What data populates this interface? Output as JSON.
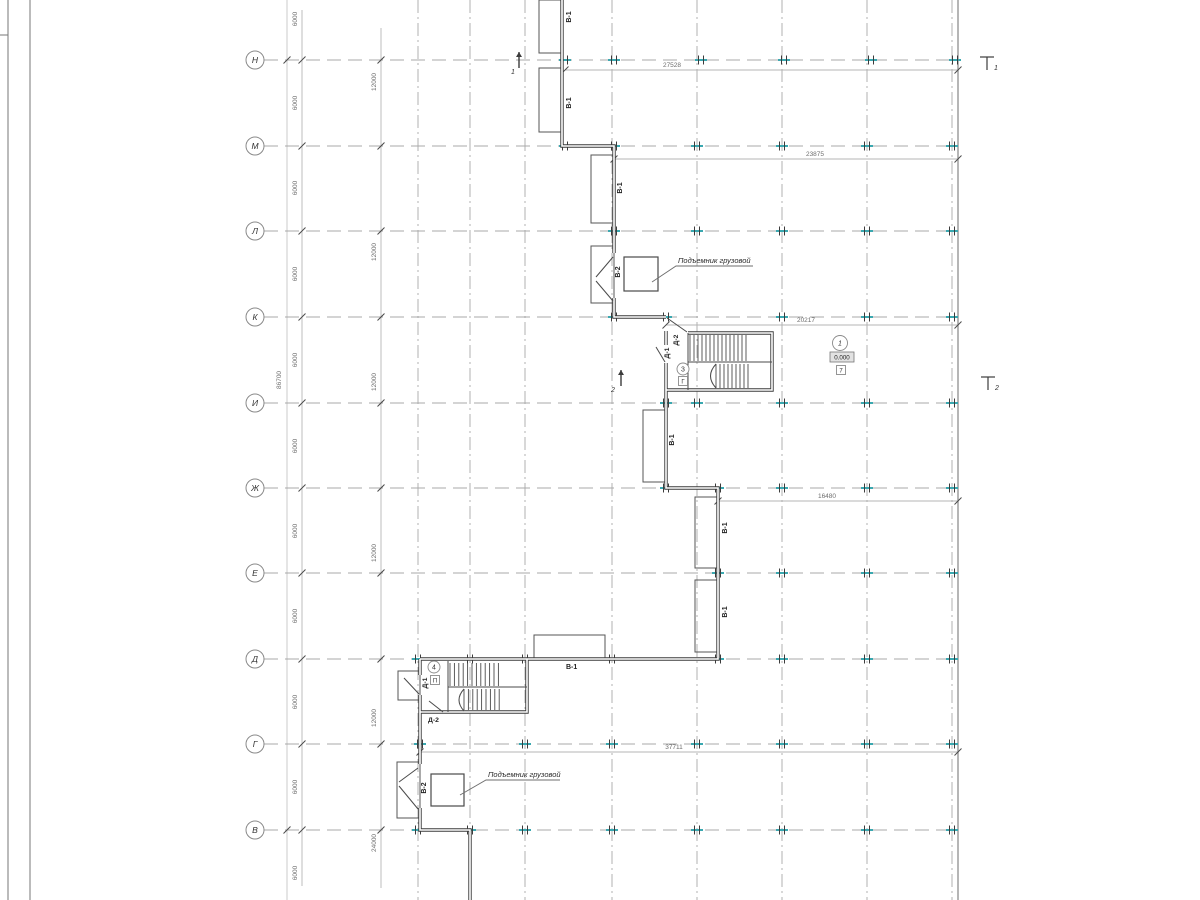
{
  "axes": {
    "letters": [
      "Н",
      "М",
      "Л",
      "К",
      "И",
      "Ж",
      "Е",
      "Д",
      "Г",
      "В"
    ]
  },
  "dims": {
    "v6000": "6000",
    "v12000": "12000",
    "v24000": "24000",
    "total_height": "86700",
    "h27528": "27528",
    "h23875": "23875",
    "h20217": "20217",
    "h16480": "16480",
    "h37711": "37711"
  },
  "labels": {
    "wall_type_1": "В-1",
    "wall_type_2": "В-2",
    "door_type_1": "Д-1",
    "door_type_2": "Д-2",
    "hoist": "Подъемник грузовой",
    "level_zero": "0.000",
    "stair1_number": "3",
    "stair1_mark": "Г",
    "stair2_number": "4",
    "stair2_mark": "П",
    "room_number": "1",
    "room_mark": "7",
    "section_1": "1",
    "section_2": "2"
  },
  "colors": {
    "wall": "#3c3c3c",
    "thin": "#555555",
    "grid": "#a8a8a8",
    "dim_line": "#b5b5b5",
    "dim_text": "#6e6e6e",
    "text": "#2b2b2b",
    "tick": "#3aa8b0",
    "frame": "#777777",
    "level_fill": "#e2e2e2"
  }
}
